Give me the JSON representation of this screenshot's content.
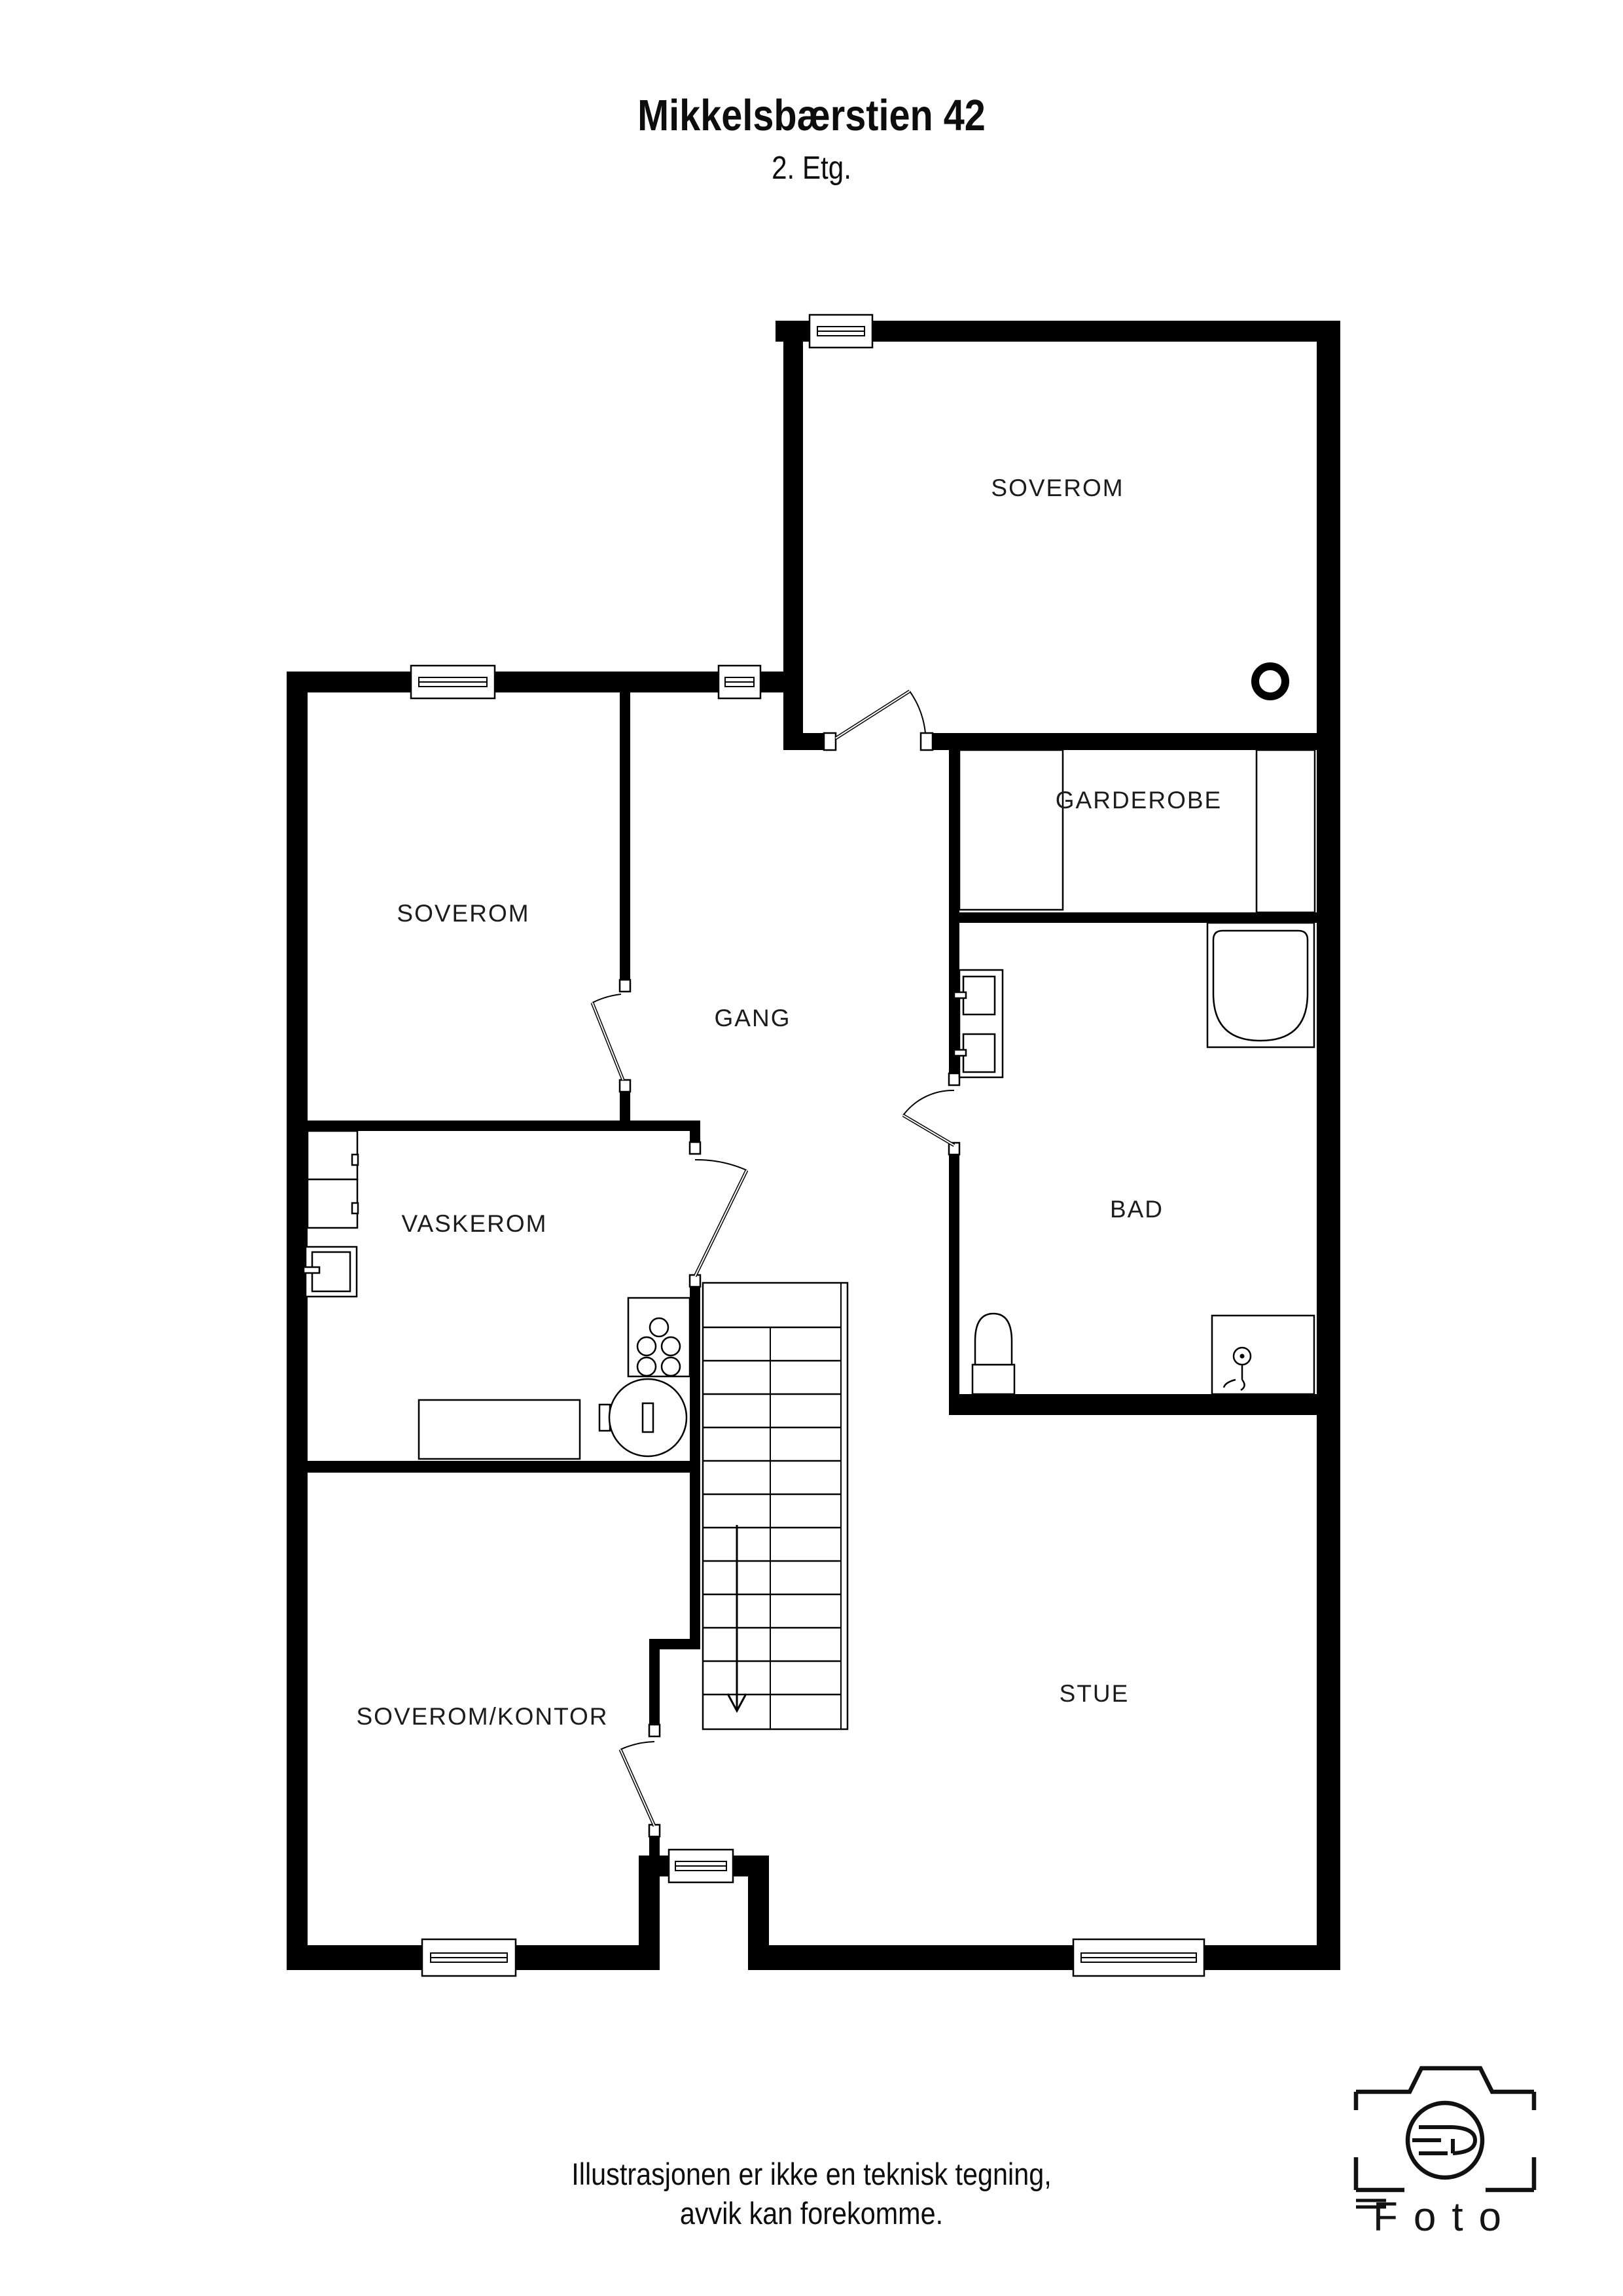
{
  "header": {
    "title": "Mikkelsbærstien 42",
    "subtitle": "2. Etg."
  },
  "rooms": [
    {
      "id": "soverom-top",
      "label": "SOVEROM"
    },
    {
      "id": "garderobe",
      "label": "GARDEROBE"
    },
    {
      "id": "soverom-left",
      "label": "SOVEROM"
    },
    {
      "id": "gang",
      "label": "GANG"
    },
    {
      "id": "bad",
      "label": "BAD"
    },
    {
      "id": "vaskerom",
      "label": "VASKEROM"
    },
    {
      "id": "soverom-kontor",
      "label": "SOVEROM/KONTOR"
    },
    {
      "id": "stue",
      "label": "STUE"
    }
  ],
  "footer": {
    "line1": "Illustrasjonen er ikke en teknisk tegning,",
    "line2": "avvik kan forekomme."
  },
  "logo": {
    "wordmark": "Foto"
  }
}
